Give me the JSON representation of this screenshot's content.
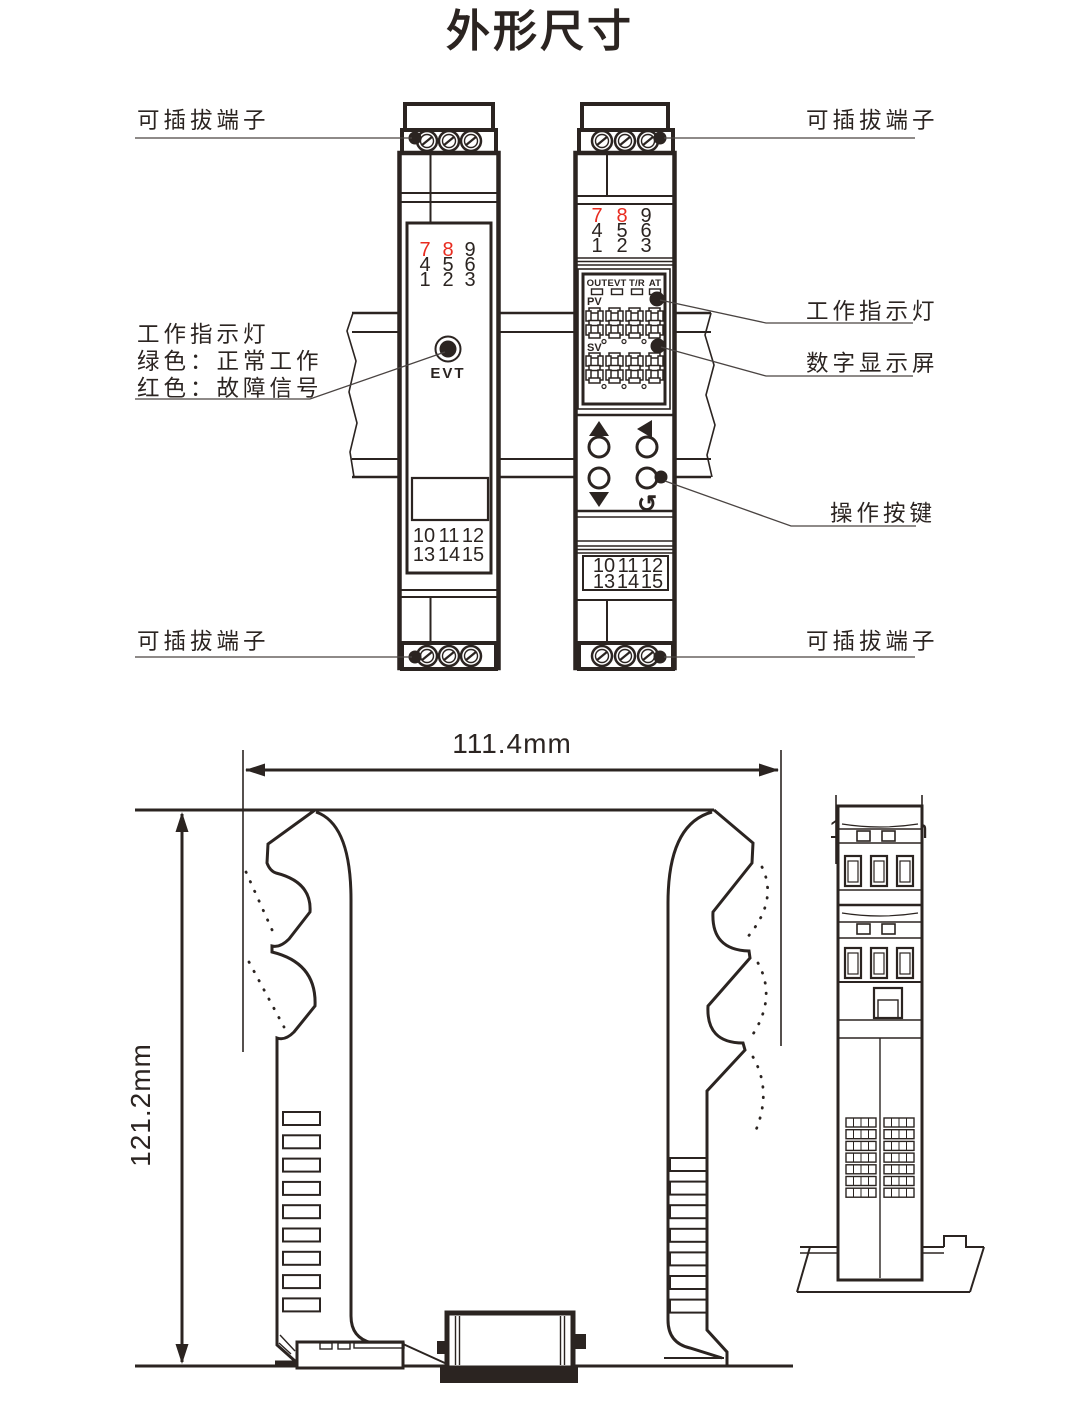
{
  "title": "外形尺寸",
  "colors": {
    "ink": "#2b2421",
    "red": "#e82b1f",
    "leader": "#4a4442"
  },
  "callouts": {
    "top_left": "可插拔端子",
    "top_right": "可插拔端子",
    "bottom_left": "可插拔端子",
    "bottom_right": "可插拔端子",
    "indicator_left_1": "工作指示灯",
    "indicator_left_2": "绿色：正常工作",
    "indicator_left_3": "红色：故障信号",
    "indicator_right": "工作指示灯",
    "display_right": "数字显示屏",
    "buttons_right": "操作按键"
  },
  "left_module": {
    "led_label": "EVT",
    "top_terminals": [
      [
        "7",
        "8",
        "9"
      ],
      [
        "4",
        "5",
        "6"
      ],
      [
        "1",
        "2",
        "3"
      ]
    ],
    "bottom_terminals": [
      [
        "10",
        "11",
        "12"
      ],
      [
        "13",
        "14",
        "15"
      ]
    ]
  },
  "right_module": {
    "status": [
      "OUT",
      "EVT",
      "T/R",
      "AT"
    ],
    "pv": "PV",
    "sv": "SV",
    "return_icon": "↺",
    "top_terminals": [
      [
        "7",
        "8",
        "9"
      ],
      [
        "4",
        "5",
        "6"
      ],
      [
        "1",
        "2",
        "3"
      ]
    ],
    "bottom_terminals": [
      [
        "10",
        "11",
        "12"
      ],
      [
        "13",
        "14",
        "15"
      ]
    ]
  },
  "dimensions": {
    "width": "111.4mm",
    "height": "121.2mm",
    "depth": "17.5mm"
  }
}
